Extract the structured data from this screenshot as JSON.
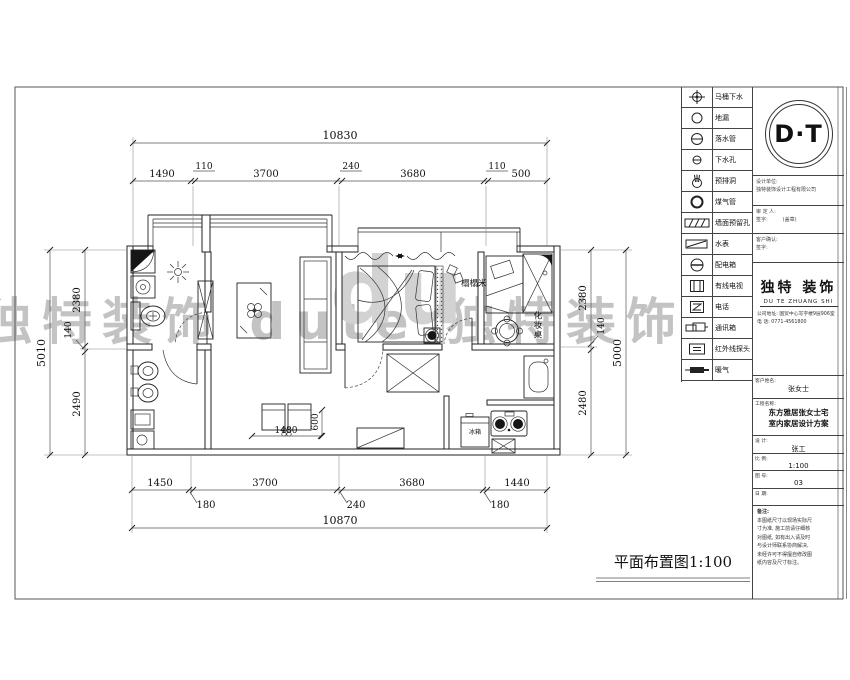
{
  "plan": {
    "title": "平面布置图1:100",
    "dims": {
      "top_overall": "10830",
      "top_segments": [
        "1490",
        "110",
        "3700",
        "240",
        "3680",
        "110",
        "500"
      ],
      "bottom_segments": [
        "1450",
        "180",
        "3700",
        "240",
        "3680",
        "180",
        "1440"
      ],
      "bottom_overall": "10870",
      "left_segments": [
        "2380",
        "140",
        "2490"
      ],
      "left_overall": "5010",
      "right_segments": [
        "2380",
        "140",
        "2480"
      ],
      "right_overall": "5000",
      "sofa_width": "1480",
      "sofa_depth": "600"
    },
    "labels": {
      "tatami": "榻榻米",
      "dresser": "化妆桌",
      "fridge": "冰箱"
    }
  },
  "legend": {
    "items": [
      {
        "icon": "toilet-drain",
        "label": "马桶下水"
      },
      {
        "icon": "floor-drain",
        "label": "地漏"
      },
      {
        "icon": "downpipe",
        "label": "落水管"
      },
      {
        "icon": "drain-hole",
        "label": "下水孔"
      },
      {
        "icon": "vent-hole",
        "label": "预排洞"
      },
      {
        "icon": "gas-pipe",
        "label": "煤气管"
      },
      {
        "icon": "wall-hole",
        "label": "墙面预留孔"
      },
      {
        "icon": "water-meter",
        "label": "水表"
      },
      {
        "icon": "power-box",
        "label": "配电箱"
      },
      {
        "icon": "cable-tv",
        "label": "有线电视"
      },
      {
        "icon": "telephone",
        "label": "电话"
      },
      {
        "icon": "comm-box",
        "label": "通讯箱"
      },
      {
        "icon": "ir-sensor",
        "label": "红外线探头"
      },
      {
        "icon": "heater",
        "label": "暖气"
      }
    ]
  },
  "title_block": {
    "logo_text": "D·T",
    "company_cn": "独特 装饰",
    "company_py": "DU TE ZHUANG SHI",
    "address_line1": "公司地址: 国贸中心写字楼9层906室",
    "address_line2": "电 话: 0771-4561800",
    "info_rows": [
      {
        "label": "设计单位:",
        "value": "独特装饰设计工程有限公司"
      },
      {
        "label": "审 定 人:",
        "value": "签字:　　　(盖章)"
      },
      {
        "label": "客户确认:",
        "value": "签字:"
      }
    ],
    "client_label": "客户姓名:",
    "client_value": "张女士",
    "project_label": "工程名称:",
    "project_line1": "东方雅居张女士宅",
    "project_line2": "室内家居设计方案",
    "designer_label": "设 计:",
    "designer_value": "张工",
    "scale_label": "比 例:",
    "scale_value": "1:100",
    "sheet_no_label": "图 号:",
    "sheet_no_value": "03",
    "date_label": "日 期:",
    "date_value": "",
    "notes_title": "备注:",
    "notes_lines": [
      "本图纸尺寸以现场实际尺",
      "寸为准, 施工前请仔细核",
      "对图纸, 如有出入请及时",
      "与设计师联系协商解决,",
      "未经许可不得擅自修改图",
      "纸内容及尺寸标注。"
    ]
  },
  "watermark": {
    "band": "独特装饰  dute  独特装饰",
    "big": "du"
  }
}
